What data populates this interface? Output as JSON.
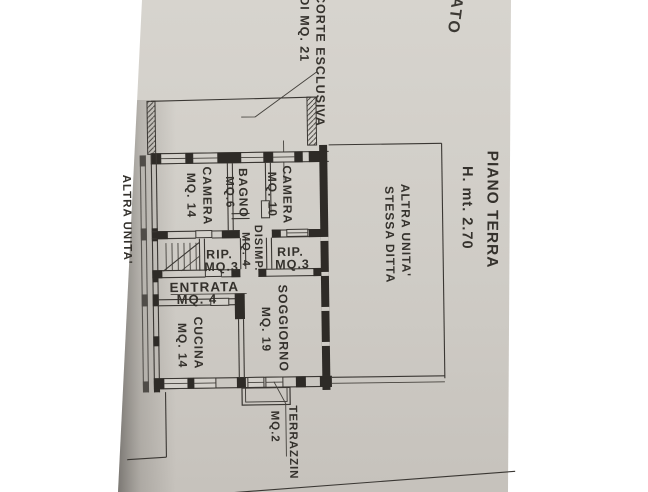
{
  "meta": {
    "kind": "photographed floor plan, rotated 90 degrees",
    "floor": "PIANO TERRA",
    "ceiling_height": "H. mt. 2.70"
  },
  "colors": {
    "paper": "#d2cfc9",
    "paper_dark": "#c7c3bd",
    "ink": "#3a3733",
    "background": "#ffffff",
    "edge_shadow": "#1f1d1b"
  },
  "annotations": {
    "top_fragment": "ATO",
    "courtyard": {
      "line1": "CORTE ESCLUSIVA",
      "line2": "DI MQ. 21"
    },
    "floor": {
      "line1": "PIANO TERRA",
      "line2": "H. mt. 2.70"
    },
    "adjacent_unit_right": {
      "line1": "ALTRA UNITA'",
      "line2": "STESSA DITTA"
    },
    "adjacent_unit_left": "ALTRA UNITA'"
  },
  "rooms": [
    {
      "name": "CAMERA",
      "area": "MQ. 14"
    },
    {
      "name": "BAGNO",
      "area": "MQ.6"
    },
    {
      "name": "CAMERA",
      "area": "MQ. 10"
    },
    {
      "name": "RIP.",
      "area": "MQ.3"
    },
    {
      "name": "DISIMP.",
      "area": "MQ. 4"
    },
    {
      "name": "RIP.",
      "area": "MQ.3"
    },
    {
      "name": "ENTRATA",
      "area": "MQ. 4"
    },
    {
      "name": "CUCINA",
      "area": "MQ. 14"
    },
    {
      "name": "SOGGIORNO",
      "area": "MQ. 19"
    },
    {
      "name": "TERRAZZIN",
      "area": "MQ.2"
    }
  ]
}
